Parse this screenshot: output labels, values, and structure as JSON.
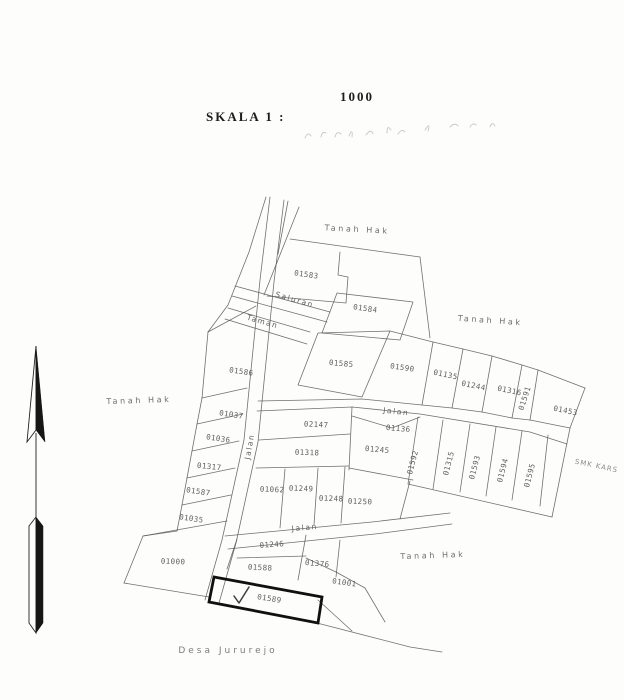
{
  "title": {
    "scale_label": "SKALA 1 :",
    "scale_value": "1000"
  },
  "map": {
    "parcels": [
      {
        "id": "01583"
      },
      {
        "id": "01584"
      },
      {
        "id": "01585"
      },
      {
        "id": "01590"
      },
      {
        "id": "01135"
      },
      {
        "id": "01244"
      },
      {
        "id": "01316"
      },
      {
        "id": "01591"
      },
      {
        "id": "01453"
      },
      {
        "id": "02147"
      },
      {
        "id": "01136"
      },
      {
        "id": "01318"
      },
      {
        "id": "01245"
      },
      {
        "id": "01592"
      },
      {
        "id": "01315"
      },
      {
        "id": "01593"
      },
      {
        "id": "01594"
      },
      {
        "id": "01595"
      },
      {
        "id": "01586"
      },
      {
        "id": "01037"
      },
      {
        "id": "01036"
      },
      {
        "id": "01317"
      },
      {
        "id": "01587"
      },
      {
        "id": "01035"
      },
      {
        "id": "01000"
      },
      {
        "id": "01062"
      },
      {
        "id": "01249"
      },
      {
        "id": "01248"
      },
      {
        "id": "01250"
      },
      {
        "id": "01246"
      },
      {
        "id": "01376"
      },
      {
        "id": "01588"
      },
      {
        "id": "01001"
      }
    ],
    "highlighted_parcel": {
      "id": "01589"
    },
    "roads": {
      "main": "Jalan",
      "middle": "Jalan",
      "lower": "Jalan",
      "channel": "Saluran",
      "strip": "Taman"
    },
    "areas": {
      "top": "Tanah Hak",
      "top_right": "Tanah Hak",
      "west": "Tanah Hak",
      "bottom_right": "Tanah Hak"
    },
    "village": "Desa Jururejo",
    "school": "SMK KARS"
  },
  "icons": {
    "north_arrow": "north-arrow",
    "check": "check-mark"
  },
  "colors": {
    "line": "#575757",
    "bold_outline": "#101010",
    "label": "#5f5f5f",
    "paper": "#fdfdfc"
  }
}
